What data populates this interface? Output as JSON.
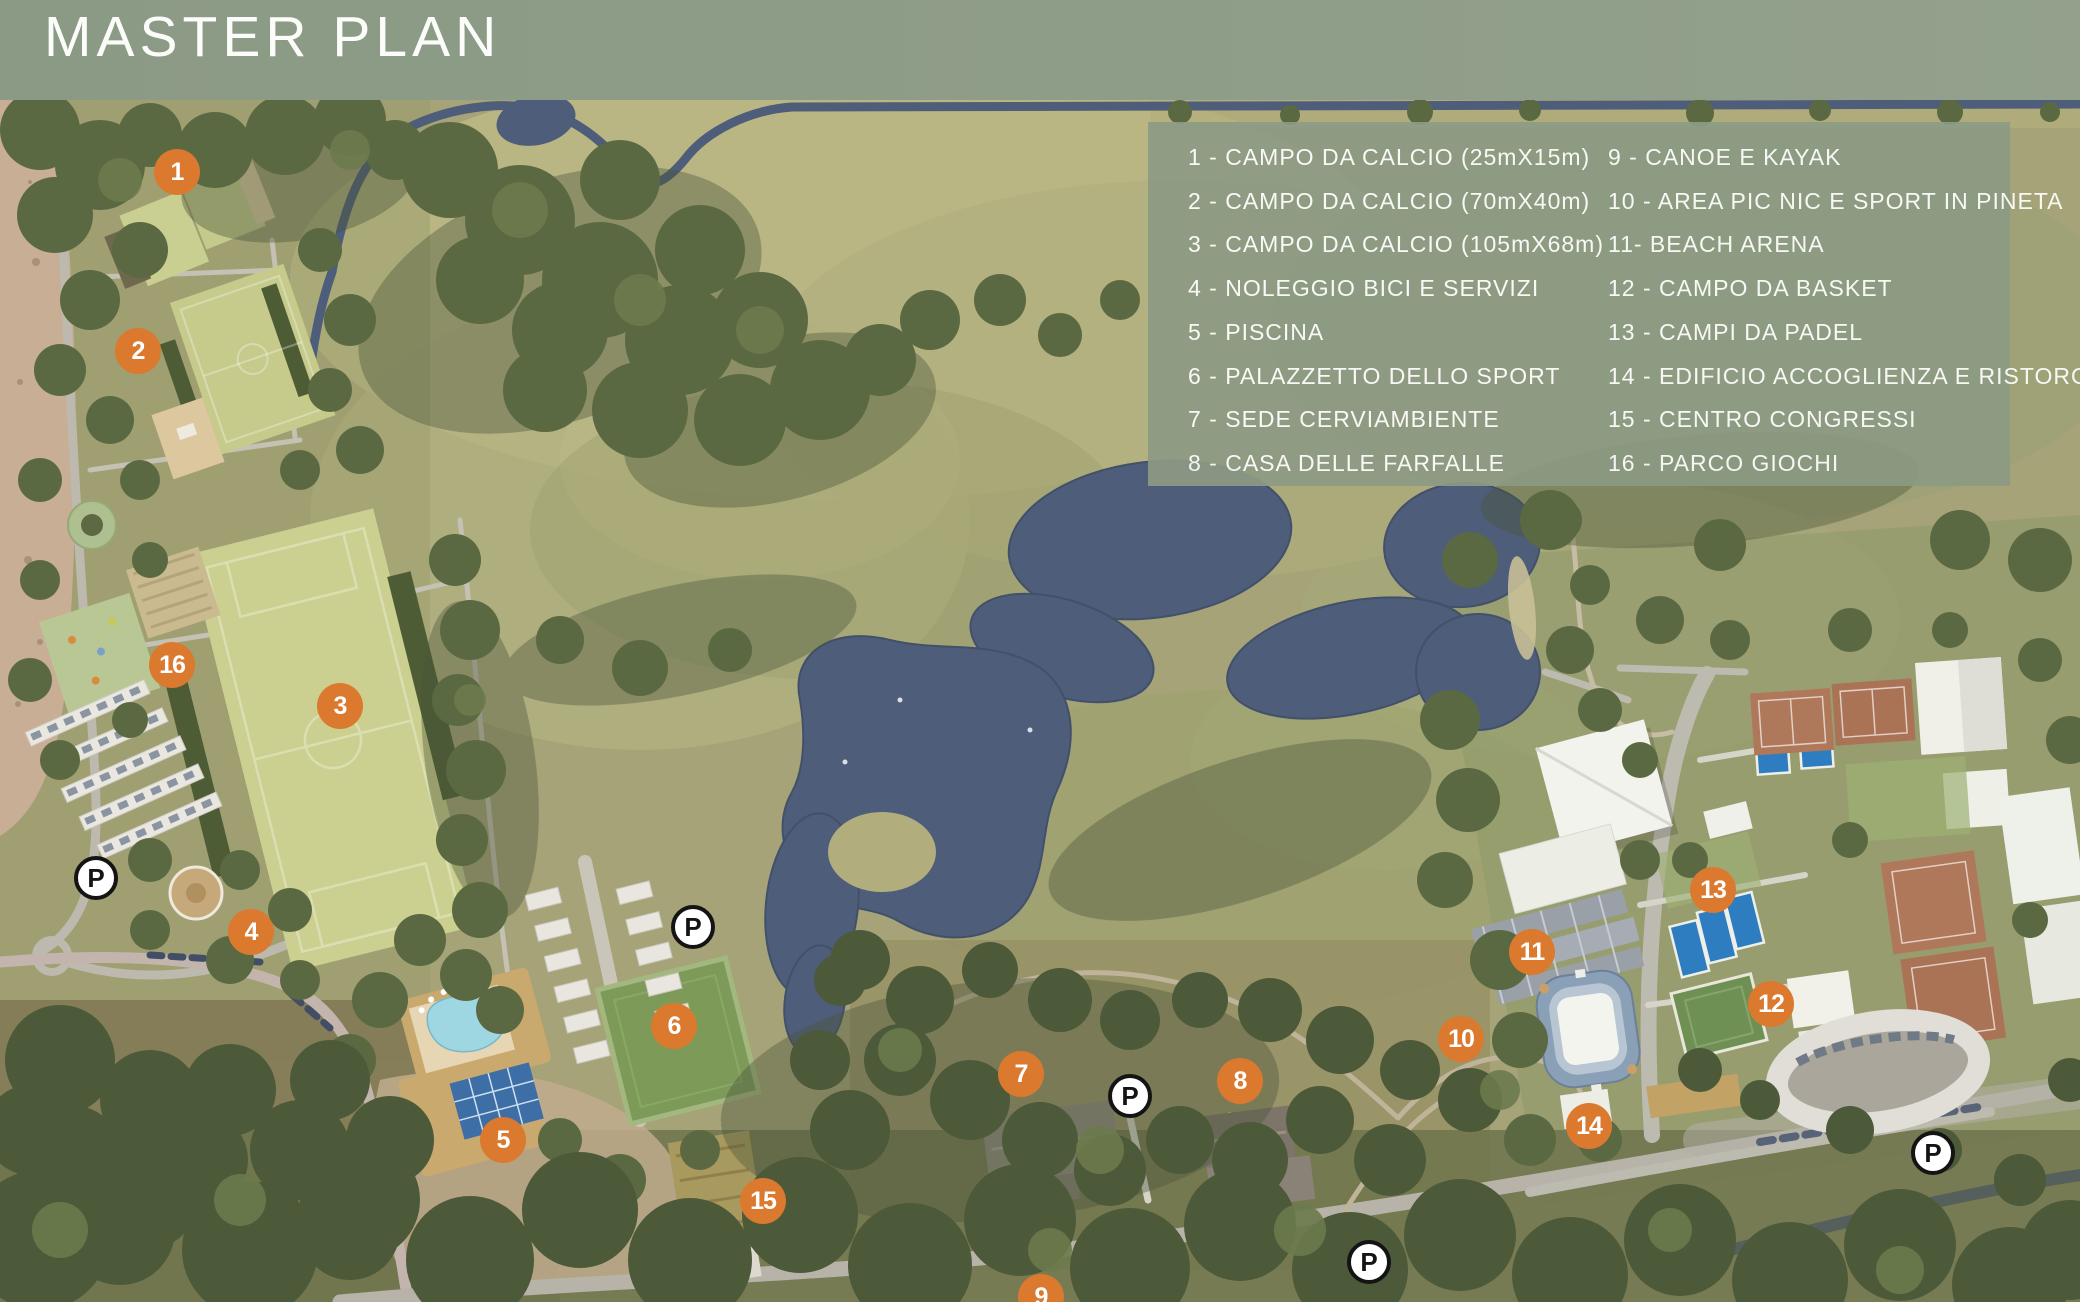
{
  "header": {
    "title": "MASTER PLAN"
  },
  "legend": {
    "col1": [
      "1 - CAMPO DA CALCIO (25mX15m)",
      "2 - CAMPO DA CALCIO (70mX40m)",
      "3 - CAMPO DA CALCIO (105mX68m)",
      "4 - NOLEGGIO BICI E SERVIZI",
      "5 - PISCINA",
      "6 - PALAZZETTO DELLO SPORT",
      "7 - SEDE CERVIAMBIENTE",
      "8 - CASA DELLE FARFALLE"
    ],
    "col2": [
      "9 - CANOE E KAYAK",
      "10 - AREA PIC NIC E SPORT IN PINETA",
      "11- BEACH ARENA",
      "12 - CAMPO DA BASKET",
      "13 - CAMPI DA PADEL",
      "14 - EDIFICIO ACCOGLIENZA E RISTORO",
      "15 - CENTRO CONGRESSI",
      "16 - PARCO GIOCHI"
    ]
  },
  "markers": [
    {
      "num": "1",
      "x": 177,
      "y": 172
    },
    {
      "num": "2",
      "x": 138,
      "y": 351
    },
    {
      "num": "3",
      "x": 340,
      "y": 706
    },
    {
      "num": "4",
      "x": 251,
      "y": 932
    },
    {
      "num": "5",
      "x": 503,
      "y": 1140
    },
    {
      "num": "6",
      "x": 674,
      "y": 1026
    },
    {
      "num": "7",
      "x": 1021,
      "y": 1074
    },
    {
      "num": "8",
      "x": 1240,
      "y": 1081
    },
    {
      "num": "9",
      "x": 1041,
      "y": 1297
    },
    {
      "num": "10",
      "x": 1461,
      "y": 1039
    },
    {
      "num": "11",
      "x": 1532,
      "y": 952
    },
    {
      "num": "12",
      "x": 1771,
      "y": 1004
    },
    {
      "num": "13",
      "x": 1713,
      "y": 890
    },
    {
      "num": "14",
      "x": 1589,
      "y": 1126
    },
    {
      "num": "15",
      "x": 763,
      "y": 1201
    },
    {
      "num": "16",
      "x": 172,
      "y": 665
    }
  ],
  "parking": [
    {
      "label": "P",
      "x": 96,
      "y": 878
    },
    {
      "label": "P",
      "x": 693,
      "y": 927
    },
    {
      "label": "P",
      "x": 1130,
      "y": 1096
    },
    {
      "label": "P",
      "x": 1369,
      "y": 1262
    },
    {
      "label": "P",
      "x": 1933,
      "y": 1153
    }
  ],
  "colors": {
    "marker_orange": "#DB792E",
    "header_green": "#8B9A85",
    "panel_green": "#8C9B84",
    "water_blue": "#4E5D79",
    "pitch_green": "#CBD090",
    "text_white": "#FFFFFF"
  }
}
